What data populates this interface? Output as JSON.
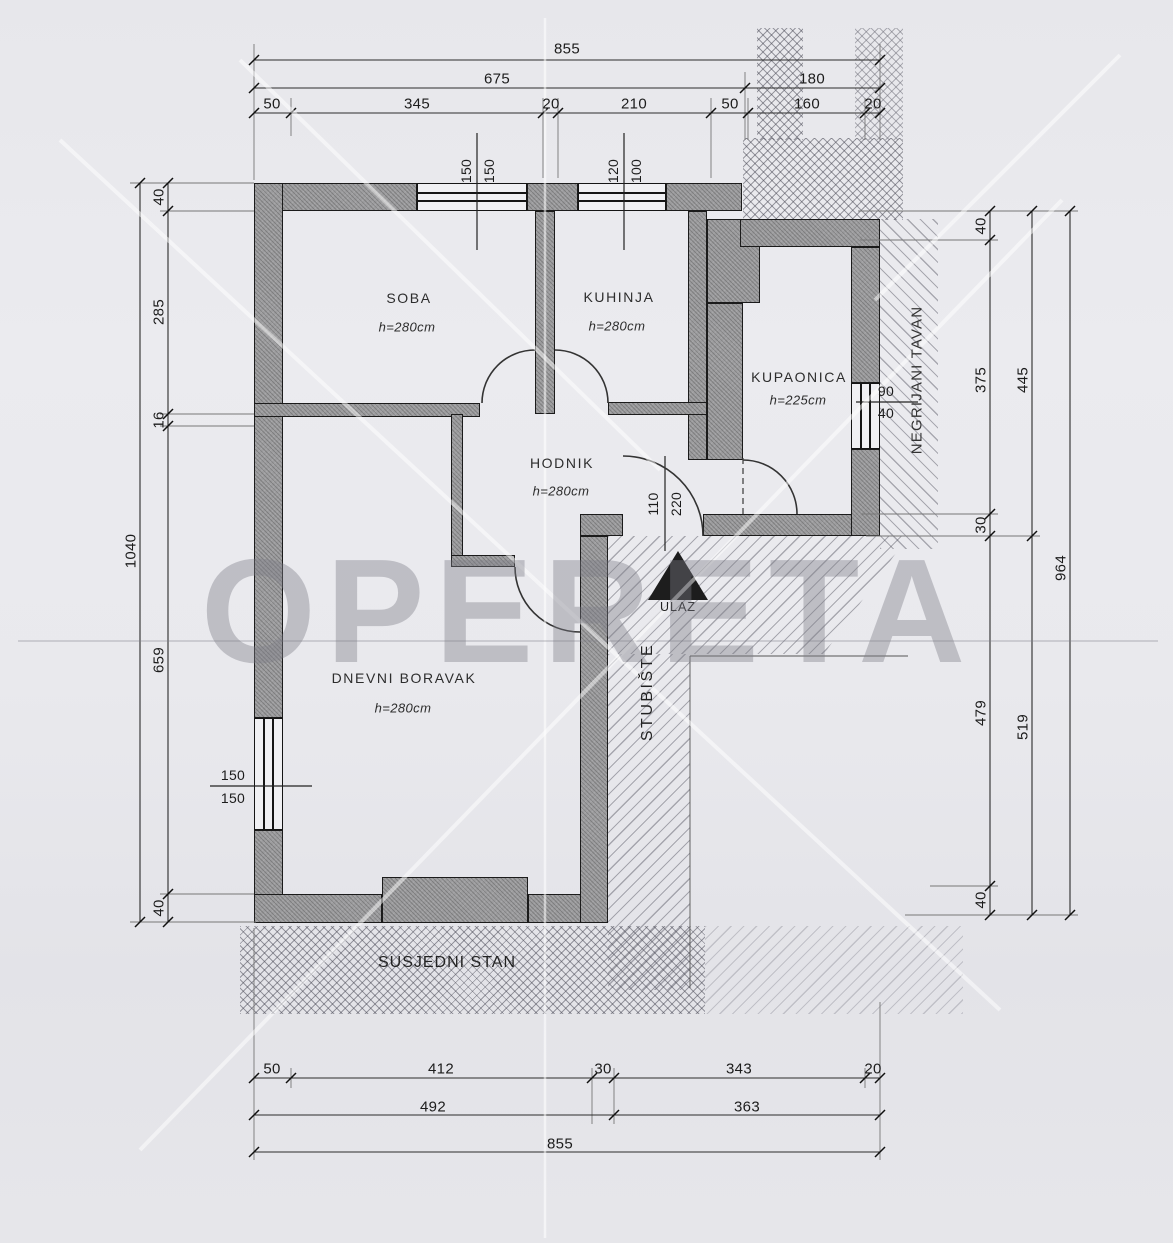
{
  "watermark": "OPERETA",
  "rooms": {
    "soba": {
      "name": "SOBA",
      "height": "h=280cm"
    },
    "kuhinja": {
      "name": "KUHINJA",
      "height": "h=280cm"
    },
    "kupaonica": {
      "name": "KUPAONICA",
      "height": "h=225cm"
    },
    "hodnik": {
      "name": "HODNIK",
      "height": "h=280cm"
    },
    "dnevni": {
      "name": "DNEVNI BORAVAK",
      "height": "h=280cm"
    }
  },
  "areas": {
    "stairs": "STUBIŠTE",
    "neighbor": "SUSJEDNI STAN",
    "attic": "NEGRIJANI TAVAN",
    "entrance": "ULAZ"
  },
  "openings": {
    "window_soba": {
      "w": "150",
      "h": "150"
    },
    "window_kuhinja": {
      "w": "120",
      "h": "100"
    },
    "window_dnevni": {
      "w": "150",
      "h": "150"
    },
    "window_kupaonica": {
      "w": "90",
      "h": "40"
    },
    "entry_door": {
      "w": "110",
      "h": "220"
    }
  },
  "dims": {
    "top": {
      "total": "855",
      "mid": [
        "675",
        "180"
      ],
      "inner": [
        "50",
        "345",
        "20",
        "210",
        "50",
        "160",
        "20"
      ]
    },
    "bottom": {
      "inner": [
        "50",
        "412",
        "30",
        "343",
        "20"
      ],
      "mid": [
        "492",
        "363"
      ],
      "total": "855"
    },
    "left": {
      "outer": "1040",
      "inner": [
        "40",
        "285",
        "16",
        "659",
        "40"
      ]
    },
    "right": {
      "outer": "964",
      "mid": [
        "445",
        "519"
      ],
      "inner": [
        "40",
        "375",
        "30",
        "479",
        "40"
      ]
    }
  }
}
